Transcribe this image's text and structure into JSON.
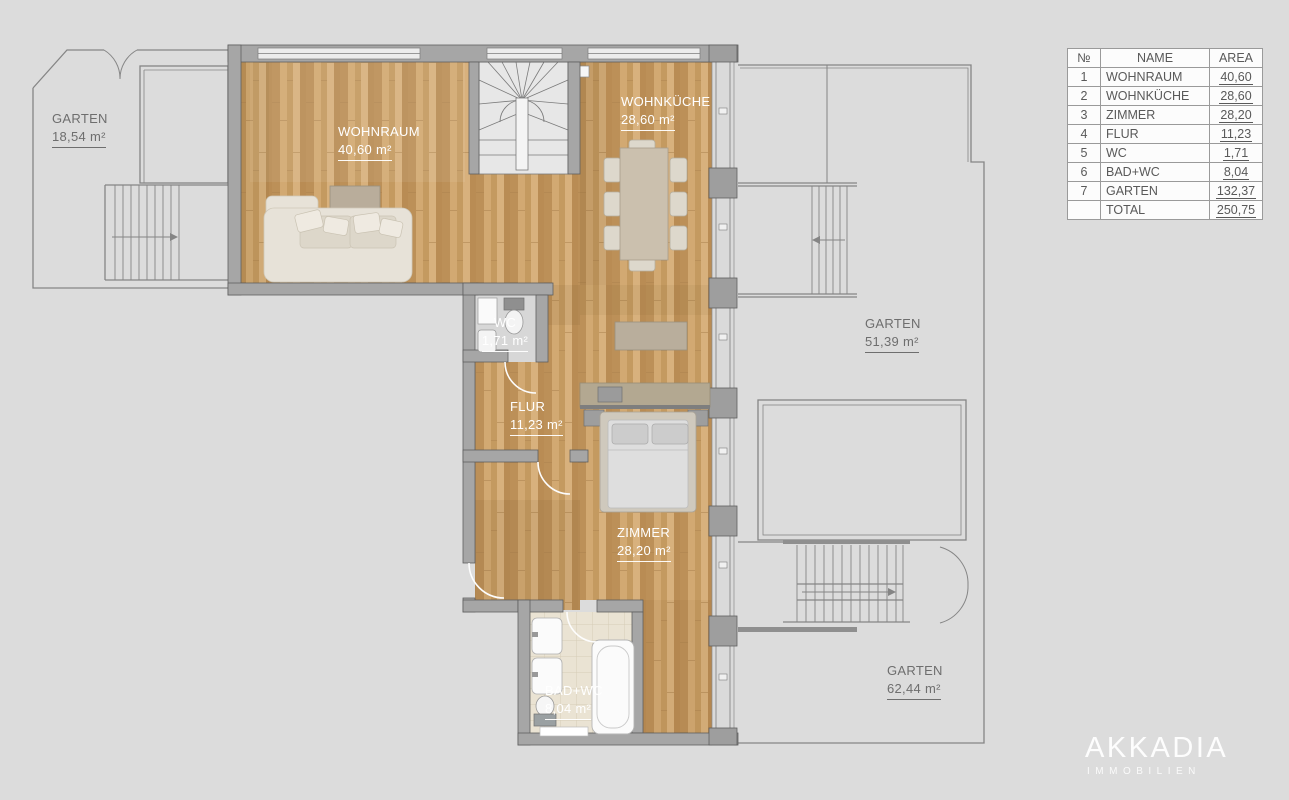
{
  "table": {
    "headers": [
      "№",
      "NAME",
      "AREA"
    ],
    "rows": [
      {
        "no": "1",
        "name": "WOHNRAUM",
        "area": "40,60"
      },
      {
        "no": "2",
        "name": "WOHNKÜCHE",
        "area": "28,60"
      },
      {
        "no": "3",
        "name": "ZIMMER",
        "area": "28,20"
      },
      {
        "no": "4",
        "name": "FLUR",
        "area": "11,23"
      },
      {
        "no": "5",
        "name": "WC",
        "area": "1,71"
      },
      {
        "no": "6",
        "name": "BAD+WC",
        "area": "8,04"
      },
      {
        "no": "7",
        "name": "GARTEN",
        "area": "132,37"
      },
      {
        "no": "",
        "name": "TOTAL",
        "area": "250,75"
      }
    ]
  },
  "rooms": {
    "wohnraum": {
      "name": "WOHNRAUM",
      "area": "40,60 m²"
    },
    "wohnkueche": {
      "name": "WOHNKÜCHE",
      "area": "28,60 m²"
    },
    "wc": {
      "name": "WC",
      "area": "1,71 m²"
    },
    "flur": {
      "name": "FLUR",
      "area": "11,23 m²"
    },
    "zimmer": {
      "name": "ZIMMER",
      "area": "28,20 m²"
    },
    "badwc": {
      "name": "BAD+WC",
      "area": "8,04 m²"
    }
  },
  "gardens": {
    "left": {
      "name": "GARTEN",
      "area": "18,54 m²"
    },
    "right_upper": {
      "name": "GARTEN",
      "area": "51,39 m²"
    },
    "right_lower": {
      "name": "GARTEN",
      "area": "62,44 m²"
    }
  },
  "logo": {
    "brand": "AKKADIA",
    "tagline": "IMMOBILIEN"
  },
  "colors": {
    "background": "#dcdcdc",
    "wall": "#a6a6a6",
    "wood": "#c99e66",
    "tile": "#eae3d3",
    "garden_line": "#858585",
    "label_light": "#ffffff",
    "label_dark": "#6e6e6e"
  }
}
